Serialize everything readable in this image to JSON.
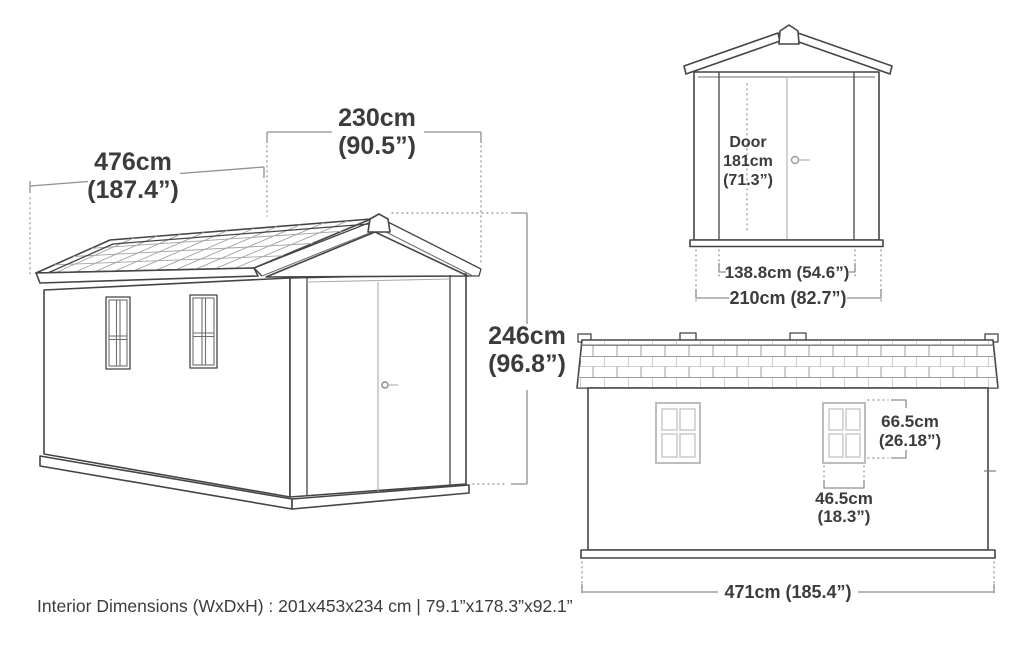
{
  "perspective_view": {
    "depth_cm": "476cm",
    "depth_in": "(187.4”)",
    "width_cm": "230cm",
    "width_in": "(90.5”)",
    "height_cm": "246cm",
    "height_in": "(96.8”)"
  },
  "front_view": {
    "door_label": "Door",
    "door_height_cm": "181cm",
    "door_height_in": "(71.3”)",
    "door_opening_width": "138.8cm (54.6”)",
    "overall_width": "210cm (82.7”)"
  },
  "side_view": {
    "window_height_cm": "66.5cm",
    "window_height_in": "(26.18”)",
    "window_width_cm": "46.5cm",
    "window_width_in": "(18.3”)",
    "overall_length": "471cm (185.4”)"
  },
  "footer": {
    "interior_dimensions": "Interior Dimensions (WxDxH) : 201x453x234 cm | 79.1”x178.3”x92.1”"
  },
  "colors": {
    "background": "#ffffff",
    "line": "#454545",
    "dimension_line": "#8f8f8f",
    "dotted_line": "#9c9c9c",
    "light_line": "#bdbdbd",
    "text": "#3c3c3c"
  }
}
